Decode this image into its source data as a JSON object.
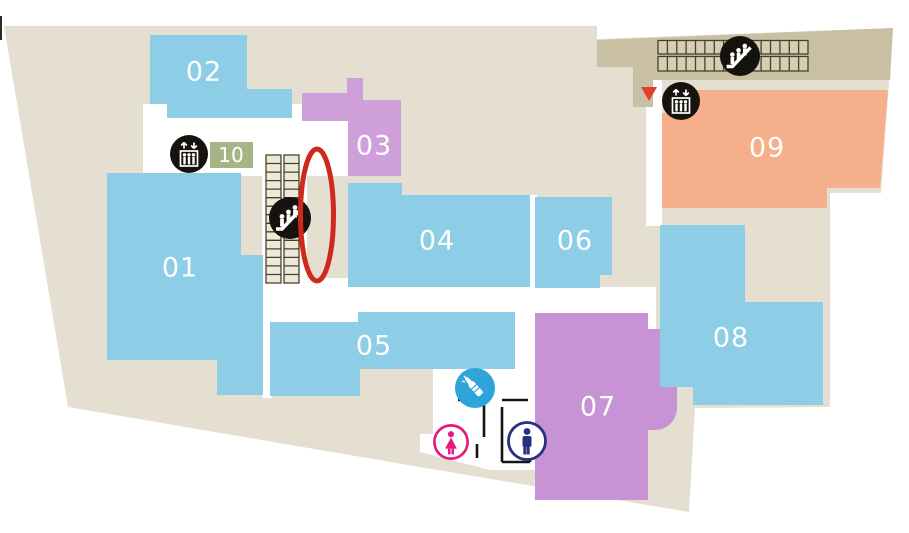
{
  "page": {
    "background": "#ffffff"
  },
  "colors": {
    "floor": "#e5dfd1",
    "corridor": "#ffffff",
    "band": "#c9c0a4",
    "band_tread": "#d6ceb3",
    "stair_tread": "#eee8d7",
    "tread_stroke": "#45412f",
    "label": "#ffffff",
    "icon_bg": "#16130e",
    "icon_fg": "#ffffff"
  },
  "rooms": {
    "r01": {
      "label": "01",
      "color": "#8dcee6"
    },
    "r02": {
      "label": "02",
      "color": "#8dcee6"
    },
    "r03": {
      "label": "03",
      "color": "#cf9fda"
    },
    "r04": {
      "label": "04",
      "color": "#8dcee6"
    },
    "r05": {
      "label": "05",
      "color": "#8dcee6"
    },
    "r06": {
      "label": "06",
      "color": "#8dcee6"
    },
    "r07": {
      "label": "07",
      "color": "#c893d4"
    },
    "r08": {
      "label": "08",
      "color": "#8dcee6"
    },
    "r09": {
      "label": "09",
      "color": "#f5af8a"
    },
    "r10": {
      "label": "10",
      "color": "#a6b587"
    }
  },
  "markers": {
    "highlight_ellipse": {
      "meaning": "highlighted escalator location",
      "color": "#d1281c"
    },
    "location_pointer": {
      "color": "#e23e2b"
    },
    "elevator": {
      "color": "#16130e"
    },
    "escalator": {
      "color": "#16130e"
    },
    "stairs": {
      "color": "#45412f"
    },
    "nursing_room": {
      "color": "#2ea4da"
    },
    "womens_restroom": {
      "color": "#e5187f"
    },
    "mens_restroom": {
      "color": "#27317f"
    },
    "walls": {
      "color": "#151515"
    }
  }
}
